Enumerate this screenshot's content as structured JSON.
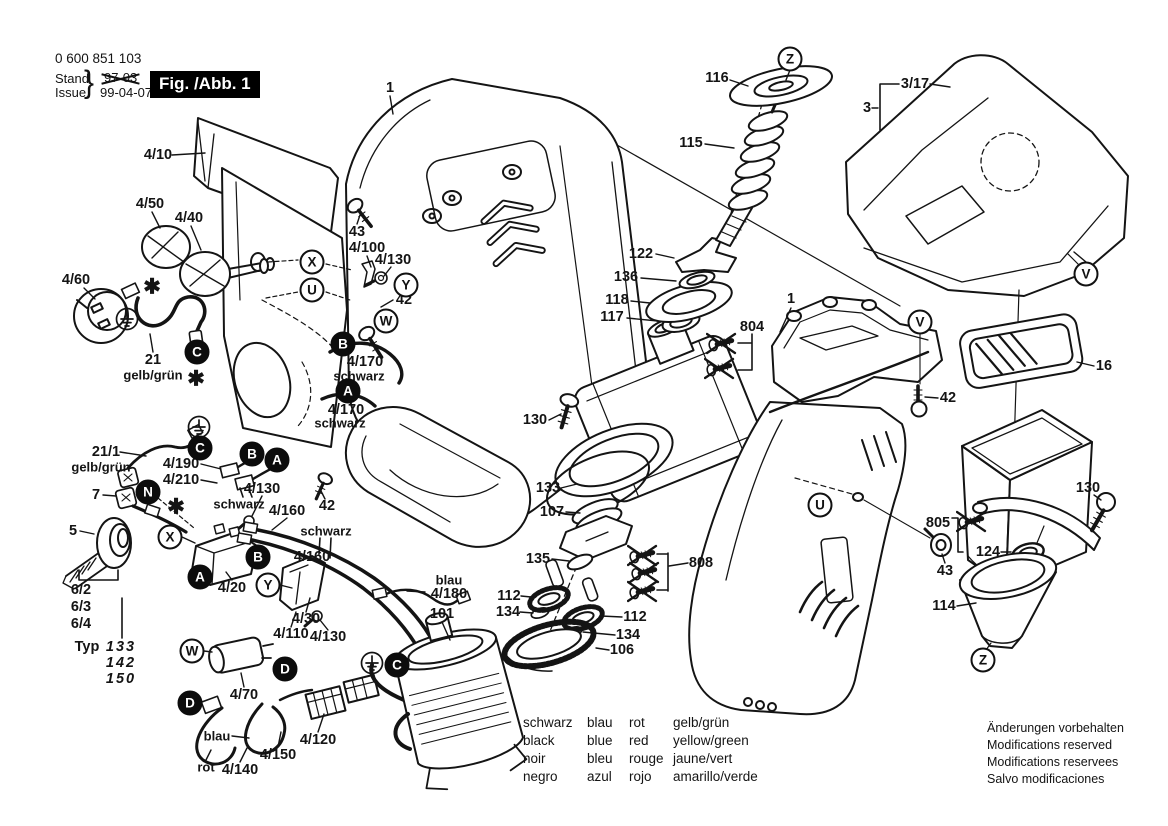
{
  "page": {
    "background": "#ffffff",
    "line_color": "#141414"
  },
  "header": {
    "part_number": "0 600 851 103",
    "stand_label": "Stand",
    "issue_label": "Issue",
    "brace": "}",
    "superseded_date": "97-03",
    "issue_date": "99-04-07",
    "figure_label": "Fig. /Abb. 1"
  },
  "part_labels": [
    {
      "t": "4/10",
      "x": 158,
      "y": 155
    },
    {
      "t": "4/50",
      "x": 150,
      "y": 204
    },
    {
      "t": "4/40",
      "x": 189,
      "y": 218
    },
    {
      "t": "4/60",
      "x": 76,
      "y": 280
    },
    {
      "t": "21",
      "x": 153,
      "y": 360
    },
    {
      "t": "gelb/grün",
      "x": 153,
      "y": 375,
      "c": "sm"
    },
    {
      "t": "21/1",
      "x": 106,
      "y": 452
    },
    {
      "t": "gelb/grün",
      "x": 101,
      "y": 467,
      "c": "sm"
    },
    {
      "t": "7",
      "x": 96,
      "y": 495
    },
    {
      "t": "5",
      "x": 73,
      "y": 531
    },
    {
      "t": "4/190",
      "x": 181,
      "y": 464
    },
    {
      "t": "4/210",
      "x": 181,
      "y": 480
    },
    {
      "t": "schwarz",
      "x": 239,
      "y": 504,
      "c": "sm"
    },
    {
      "t": "4/130",
      "x": 262,
      "y": 489
    },
    {
      "t": "4/160",
      "x": 287,
      "y": 511
    },
    {
      "t": "schwarz",
      "x": 326,
      "y": 531,
      "c": "sm"
    },
    {
      "t": "4/160",
      "x": 312,
      "y": 557
    },
    {
      "t": "4/20",
      "x": 232,
      "y": 588
    },
    {
      "t": "4/30",
      "x": 306,
      "y": 619
    },
    {
      "t": "4/110",
      "x": 291,
      "y": 634
    },
    {
      "t": "4/130",
      "x": 328,
      "y": 637
    },
    {
      "t": "6/2",
      "x": 81,
      "y": 590
    },
    {
      "t": "6/3",
      "x": 81,
      "y": 607
    },
    {
      "t": "6/4",
      "x": 81,
      "y": 624
    },
    {
      "t": "Typ",
      "x": 87,
      "y": 647
    },
    {
      "t": "133",
      "x": 121,
      "y": 647,
      "c": "it"
    },
    {
      "t": "142",
      "x": 121,
      "y": 663,
      "c": "it"
    },
    {
      "t": "150",
      "x": 121,
      "y": 679,
      "c": "it"
    },
    {
      "t": "4/70",
      "x": 244,
      "y": 695
    },
    {
      "t": "blau",
      "x": 217,
      "y": 736,
      "c": "sm"
    },
    {
      "t": "rot",
      "x": 206,
      "y": 767,
      "c": "sm"
    },
    {
      "t": "4/140",
      "x": 240,
      "y": 770
    },
    {
      "t": "4/150",
      "x": 278,
      "y": 755
    },
    {
      "t": "4/120",
      "x": 318,
      "y": 740
    },
    {
      "t": "1",
      "x": 390,
      "y": 88
    },
    {
      "t": "43",
      "x": 357,
      "y": 232
    },
    {
      "t": "4/100",
      "x": 367,
      "y": 248
    },
    {
      "t": "4/130",
      "x": 393,
      "y": 260
    },
    {
      "t": "42",
      "x": 404,
      "y": 300
    },
    {
      "t": "4/170",
      "x": 365,
      "y": 362
    },
    {
      "t": "schwarz",
      "x": 359,
      "y": 376,
      "c": "sm"
    },
    {
      "t": "4/170",
      "x": 346,
      "y": 410
    },
    {
      "t": "schwarz",
      "x": 340,
      "y": 423,
      "c": "sm"
    },
    {
      "t": "42",
      "x": 327,
      "y": 506
    },
    {
      "t": "blau",
      "x": 449,
      "y": 580,
      "c": "sm"
    },
    {
      "t": "4/180",
      "x": 449,
      "y": 594
    },
    {
      "t": "101",
      "x": 442,
      "y": 614
    },
    {
      "t": "130",
      "x": 535,
      "y": 420
    },
    {
      "t": "133",
      "x": 548,
      "y": 488
    },
    {
      "t": "107",
      "x": 552,
      "y": 512
    },
    {
      "t": "135",
      "x": 538,
      "y": 559
    },
    {
      "t": "808",
      "x": 701,
      "y": 563
    },
    {
      "t": "112",
      "x": 509,
      "y": 596
    },
    {
      "t": "134",
      "x": 508,
      "y": 612
    },
    {
      "t": "112",
      "x": 635,
      "y": 617
    },
    {
      "t": "134",
      "x": 628,
      "y": 635
    },
    {
      "t": "106",
      "x": 622,
      "y": 650
    },
    {
      "t": "116",
      "x": 717,
      "y": 78
    },
    {
      "t": "115",
      "x": 691,
      "y": 143
    },
    {
      "t": "122",
      "x": 641,
      "y": 254
    },
    {
      "t": "136",
      "x": 626,
      "y": 277
    },
    {
      "t": "118",
      "x": 617,
      "y": 300
    },
    {
      "t": "117",
      "x": 612,
      "y": 317
    },
    {
      "t": "804",
      "x": 752,
      "y": 327
    },
    {
      "t": "1",
      "x": 791,
      "y": 299
    },
    {
      "t": "3/17",
      "x": 915,
      "y": 84
    },
    {
      "t": "3",
      "x": 867,
      "y": 108
    },
    {
      "t": "16",
      "x": 1104,
      "y": 366
    },
    {
      "t": "42",
      "x": 948,
      "y": 398
    },
    {
      "t": "130",
      "x": 1088,
      "y": 488
    },
    {
      "t": "805",
      "x": 938,
      "y": 523
    },
    {
      "t": "124",
      "x": 988,
      "y": 552
    },
    {
      "t": "43",
      "x": 945,
      "y": 571
    },
    {
      "t": "114",
      "x": 944,
      "y": 606
    }
  ],
  "callouts": {
    "white": [
      {
        "t": "X",
        "x": 312,
        "y": 262
      },
      {
        "t": "U",
        "x": 312,
        "y": 290
      },
      {
        "t": "Y",
        "x": 406,
        "y": 285
      },
      {
        "t": "W",
        "x": 386,
        "y": 321
      },
      {
        "t": "X",
        "x": 170,
        "y": 537
      },
      {
        "t": "Y",
        "x": 268,
        "y": 585
      },
      {
        "t": "W",
        "x": 192,
        "y": 651
      },
      {
        "t": "Z",
        "x": 790,
        "y": 59
      },
      {
        "t": "V",
        "x": 1086,
        "y": 274
      },
      {
        "t": "V",
        "x": 920,
        "y": 322
      },
      {
        "t": "U",
        "x": 820,
        "y": 505
      },
      {
        "t": "Z",
        "x": 983,
        "y": 660
      }
    ],
    "black": [
      {
        "t": "C",
        "x": 197,
        "y": 352
      },
      {
        "t": "B",
        "x": 343,
        "y": 344
      },
      {
        "t": "A",
        "x": 348,
        "y": 391
      },
      {
        "t": "C",
        "x": 200,
        "y": 448
      },
      {
        "t": "B",
        "x": 252,
        "y": 454
      },
      {
        "t": "A",
        "x": 277,
        "y": 460
      },
      {
        "t": "N",
        "x": 148,
        "y": 492
      },
      {
        "t": "B",
        "x": 258,
        "y": 557
      },
      {
        "t": "A",
        "x": 200,
        "y": 577
      },
      {
        "t": "D",
        "x": 285,
        "y": 669
      },
      {
        "t": "D",
        "x": 190,
        "y": 703
      },
      {
        "t": "C",
        "x": 397,
        "y": 665
      }
    ]
  },
  "symbols": {
    "asterisk_glyph": "✱",
    "asterisks": [
      [
        152,
        287
      ],
      [
        196,
        379
      ],
      [
        176,
        507
      ]
    ],
    "ground": [
      [
        127,
        319
      ],
      [
        199,
        427
      ],
      [
        372,
        663
      ]
    ],
    "crossed_screws": [
      [
        722,
        343
      ],
      [
        720,
        368
      ],
      [
        643,
        555
      ],
      [
        645,
        572
      ],
      [
        643,
        591
      ],
      [
        972,
        521
      ]
    ]
  },
  "legend": {
    "columns": [
      [
        "schwarz",
        "black",
        "noir",
        "negro"
      ],
      [
        "blau",
        "blue",
        "bleu",
        "azul"
      ],
      [
        "rot",
        "red",
        "rouge",
        "rojo"
      ],
      [
        "gelb/grün",
        "yellow/green",
        "jaune/vert",
        "amarillo/verde"
      ]
    ]
  },
  "footer_lines": [
    "Änderungen vorbehalten",
    "Modifications reserved",
    "Modifications reservees",
    "Salvo modificaciones"
  ]
}
